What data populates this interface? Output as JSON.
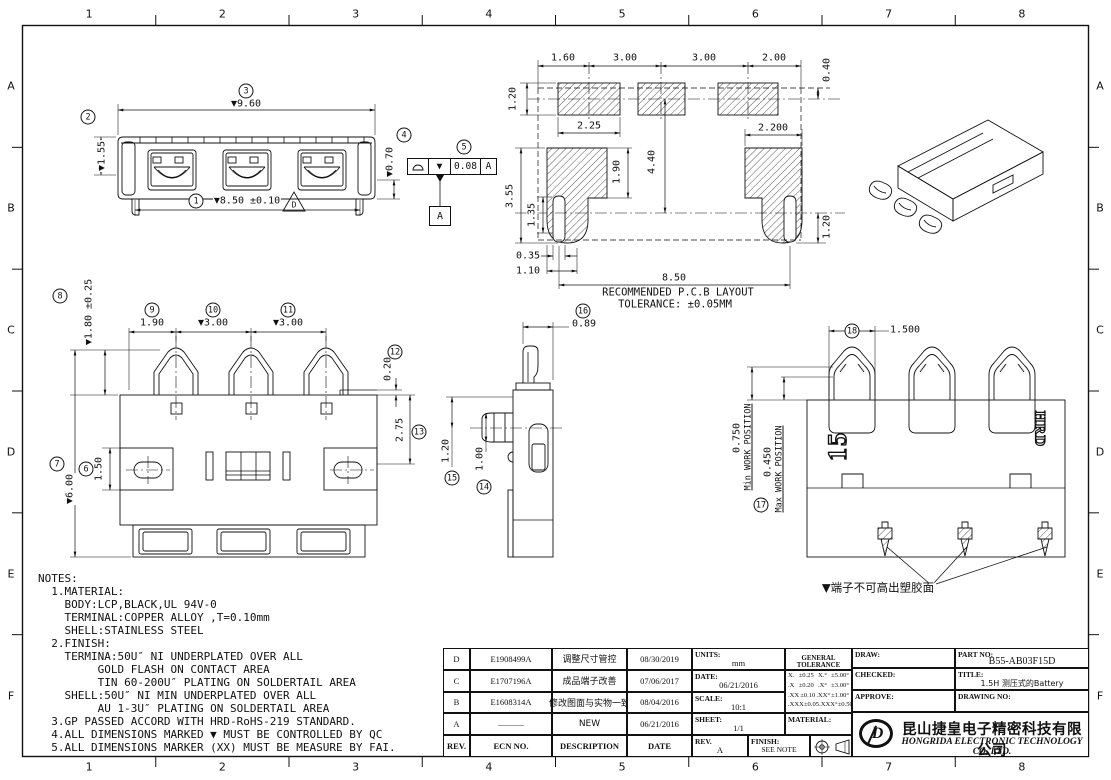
{
  "frame": {
    "cols": [
      "1",
      "2",
      "3",
      "4",
      "5",
      "6",
      "7",
      "8"
    ],
    "rows": [
      "A",
      "B",
      "C",
      "D",
      "E",
      "F"
    ]
  },
  "balloons": {
    "b1": "1",
    "b2": "2",
    "b3": "3",
    "b4": "4",
    "b5": "5",
    "b6": "6",
    "b7": "7",
    "b8": "8",
    "b9": "9",
    "b10": "10",
    "b11": "11",
    "b12": "12",
    "b13": "13",
    "b14": "14",
    "b15": "15",
    "b16": "16",
    "b17": "17",
    "b18": "18"
  },
  "labels": {
    "f_960": "▼9.60",
    "f_155": "▼1.55",
    "f_850": "▼8.50 ±0.10",
    "f_070": "▼0.70",
    "p_160": "1.60",
    "p_300a": "3.00",
    "p_300b": "3.00",
    "p_200": "2.00",
    "p_040": "0.40",
    "p_120l": "1.20",
    "p_225": "2.25",
    "p_2200": "2.200",
    "p_440": "4.40",
    "p_190": "1.90",
    "p_355": "3.55",
    "p_135": "1.35",
    "p_120r": "1.20",
    "p_035": "0.35",
    "p_110": "1.10",
    "p_850": "8.50",
    "pcb_cap1": "RECOMMENDED P.C.B LAYOUT",
    "pcb_cap2": "TOLERANCE: ±0.05MM",
    "t_190": "1.90",
    "t_300a": "▼3.00",
    "t_300b": "▼3.00",
    "t_180": "▼1.80 ±0.25",
    "t_600": "▼6.00",
    "t_150": "1.50",
    "t_020": "0.20",
    "t_275": "2.75",
    "s_089": "0.89",
    "s_120": "1.20",
    "s_100": "1.00",
    "r_1500": "1.500",
    "r_0750": "0.750",
    "r_min": "Min WORK POSITION",
    "r_0450": "0.450",
    "r_max": "Max WORK POSITION",
    "r_note": "▼端子不可高出塑胶面",
    "r_15": "15",
    "r_hrd": "HRD"
  },
  "gdt": {
    "qc": "▼",
    "tol": "0.08",
    "datum": "A",
    "datum_box": "A",
    "flag": "D"
  },
  "notes": [
    "NOTES:",
    "  1.MATERIAL:",
    "    BODY:LCP,BLACK,UL 94V-0",
    "    TERMINAL:COPPER ALLOY ,T=0.10mm",
    "    SHELL:STAINLESS STEEL",
    "  2.FINISH:",
    "    TERMINA:50U″ NI UNDERPLATED OVER ALL",
    "         GOLD FLASH ON CONTACT AREA",
    "         TIN 60-200U″ PLATING ON SOLDERTAIL AREA",
    "    SHELL:50U″ NI MIN UNDERPLATED OVER ALL",
    "         AU 1-3U″ PLATING ON SOLDERTAIL AREA",
    "  3.GP PASSED ACCORD WITH HRD-RoHS-219 STANDARD.",
    "  4.ALL DIMENSIONS MARKED ▼ MUST BE CONTROLLED BY QC",
    "  5.ALL DIMENSIONS MARKER (XX) MUST BE MEASURE BY FAI."
  ],
  "rev_table": {
    "headers": {
      "rev": "REV.",
      "ecn": "ECN NO.",
      "desc": "DESCRIPTION",
      "date": "DATE"
    },
    "rows": [
      {
        "rev": "D",
        "ecn": "E1908499A",
        "desc": "调整尺寸管控",
        "date": "08/30/2019"
      },
      {
        "rev": "C",
        "ecn": "E1707196A",
        "desc": "成品端子改善",
        "date": "07/06/2017"
      },
      {
        "rev": "B",
        "ecn": "E1608314A",
        "desc": "修改图面与实物一致",
        "date": "08/04/2016"
      },
      {
        "rev": "A",
        "ecn": "———",
        "desc": "NEW",
        "date": "06/21/2016"
      }
    ]
  },
  "info": {
    "units_label": "UNITS:",
    "units": "mm",
    "date_label": "DATE:",
    "date": "06/21/2016",
    "scale_label": "SCALE:",
    "scale": "10:1",
    "sheet_label": "SHEET:",
    "sheet": "1/1",
    "rev_label": "REV.",
    "rev": "A",
    "material_label": "MATERIAL:",
    "finish_label": "FINISH:",
    "finish": "SEE NOTE"
  },
  "tolerance": {
    "title": "GENERAL TOLERANCE",
    "linear": [
      [
        "X.",
        "±0.25"
      ],
      [
        ".X",
        "±0.20"
      ],
      [
        ".XX",
        "±0.10"
      ],
      [
        ".XXX",
        "±0.05"
      ]
    ],
    "angular": [
      [
        "X.°",
        "±5.00°"
      ],
      [
        ".X°",
        "±3.00°"
      ],
      [
        ".XX°",
        "±1.00°"
      ],
      [
        ".XXX°",
        "±0.50°"
      ]
    ]
  },
  "sign": {
    "draw_label": "DRAW:",
    "checked_label": "CHECKED:",
    "approve_label": "APPROVE:",
    "part_label": "PART NO:",
    "part_no": "B55-AB03F15D",
    "title_label": "TITLE:",
    "title": "1.5H 测压式的Battery",
    "drawing_label": "DRAWING NO:"
  },
  "company": {
    "logo": "D",
    "cn": "昆山捷皇电子精密科技有限公司",
    "en": "HONGRIDA ELECTRONIC TECHNOLOGY CO, LTD."
  },
  "colors": {
    "ink": "#111111",
    "paper": "#ffffff"
  }
}
